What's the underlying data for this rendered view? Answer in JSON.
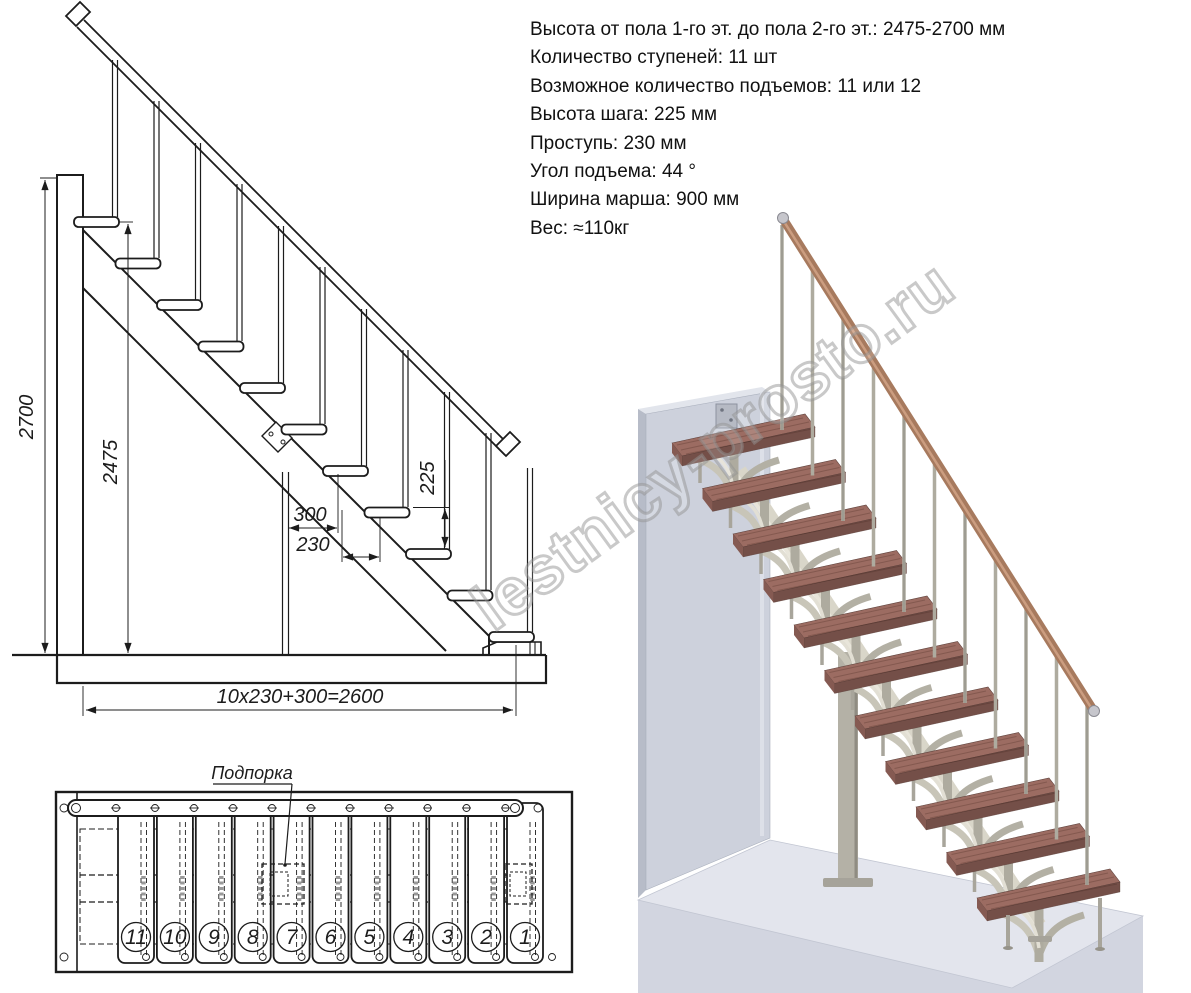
{
  "specs": {
    "lines": [
      "Высота от пола 1-го эт. до пола 2-го эт.: 2475-2700 мм",
      "Количество ступеней: 11 шт",
      "Возможное количество подъемов: 11 или 12",
      "Высота шага: 225 мм",
      "Проступь: 230 мм",
      "Угол подъема: 44 °",
      "Ширина марша: 900 мм",
      "Вес: ≈110кг"
    ]
  },
  "side_view": {
    "dim_total_height": "2700",
    "dim_floor_height": "2475",
    "dim_step_height": "225",
    "dim_support_offset": "300",
    "dim_tread_depth": "230",
    "dim_total_run": "10x230+300=2600"
  },
  "plan_view": {
    "support_label": "Подпорка",
    "step_numbers": [
      "11",
      "10",
      "9",
      "8",
      "7",
      "6",
      "5",
      "4",
      "3",
      "2",
      "1"
    ]
  },
  "watermark": {
    "text": "lestnicy-prosto.ru"
  },
  "colors": {
    "drawing_line": "#1c1c1c",
    "tread_wood_top": "#9c6c62",
    "tread_wood_front": "#744f48",
    "handrail_wood": "#a77a5e",
    "metal_gray": "#aeab9f",
    "wall_gray": "#cdd1dc",
    "floor_slab": "#e3e5ed",
    "watermark_gray": "#919191"
  }
}
